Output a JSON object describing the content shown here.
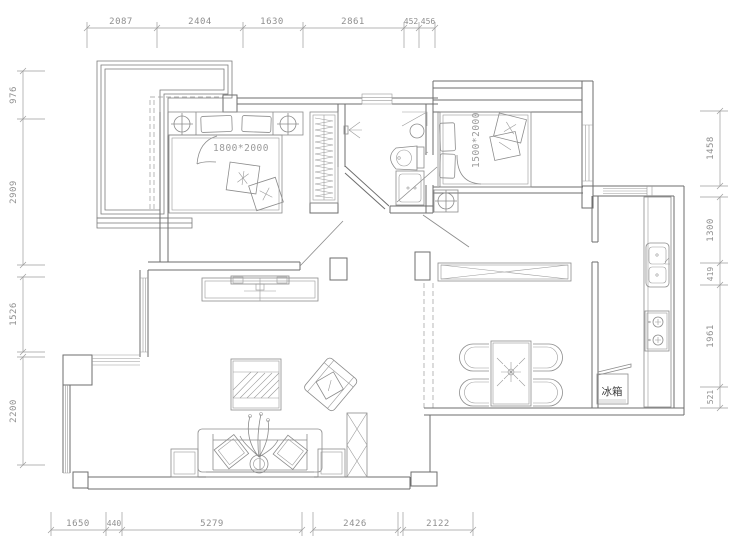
{
  "drawing_type": "apartment-floor-plan",
  "dimensions": {
    "top": [
      "2087",
      "2404",
      "1630",
      "2861",
      "452",
      "456"
    ],
    "bottom": [
      "1650",
      "440",
      "5279",
      "2426",
      "2122"
    ],
    "left": [
      "976",
      "2909",
      "1526",
      "2200"
    ],
    "right": [
      "1458",
      "1300",
      "419",
      "1961",
      "521"
    ]
  },
  "labels": {
    "master_bed_size": "1800*2000",
    "second_bed_size": "1500*2000",
    "fridge": "冰箱"
  },
  "legend": {
    "units": "mm",
    "rooms_depicted": [
      "master-bedroom",
      "second-bedroom",
      "bathroom",
      "kitchen",
      "dining-room",
      "living-room",
      "balcony",
      "bay-window"
    ]
  },
  "colors": {
    "background": "#ffffff",
    "wall_line": "#6e6e6e",
    "furniture_line": "#8c8c8c",
    "dimension_line": "#9c9c9c",
    "dimension_text": "#8f8f8f",
    "annotation_text": "#9a9a9a",
    "cn_label_text": "#3c3c3c"
  }
}
